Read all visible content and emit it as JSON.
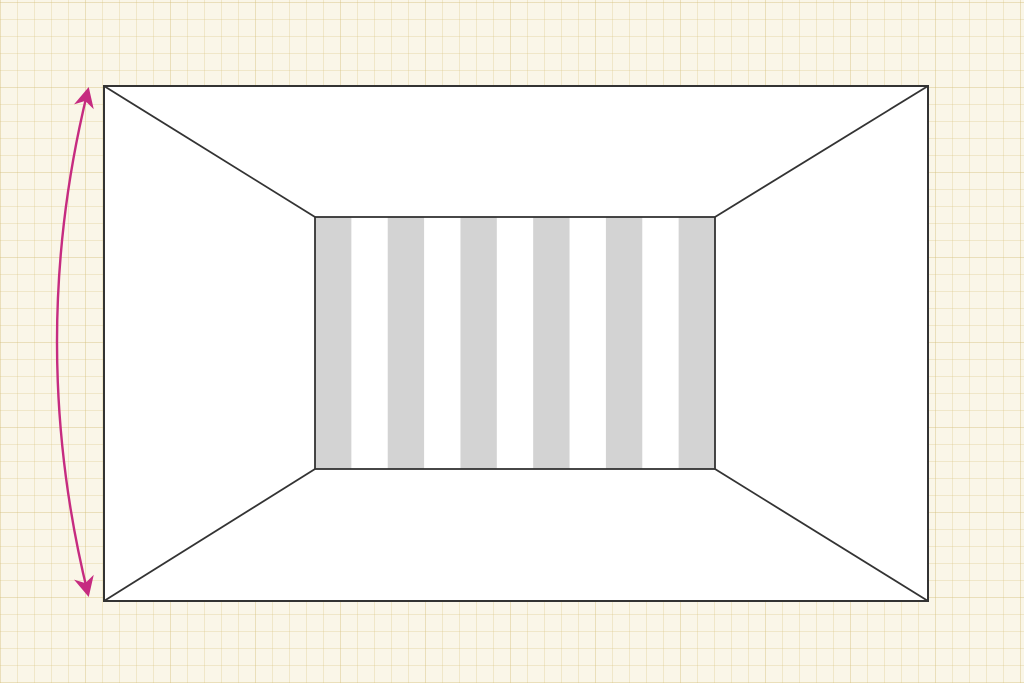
{
  "figure": {
    "kind": "corridor-perspective-illusion",
    "colors": {
      "paper": "#faf6e8",
      "grid_line": "#e7dcb8",
      "outline": "#333333",
      "wall_fill": "#ffffff",
      "stripe_gray": "#d3d3d3",
      "stripe_white": "#ffffff",
      "arrow_pink": "#c62b80"
    },
    "stripes": {
      "count": 11,
      "first": "gray",
      "alternating": true
    },
    "arrow": {
      "icon": "double-headed-arrow-icon",
      "style": "curved-vertical-span"
    }
  }
}
